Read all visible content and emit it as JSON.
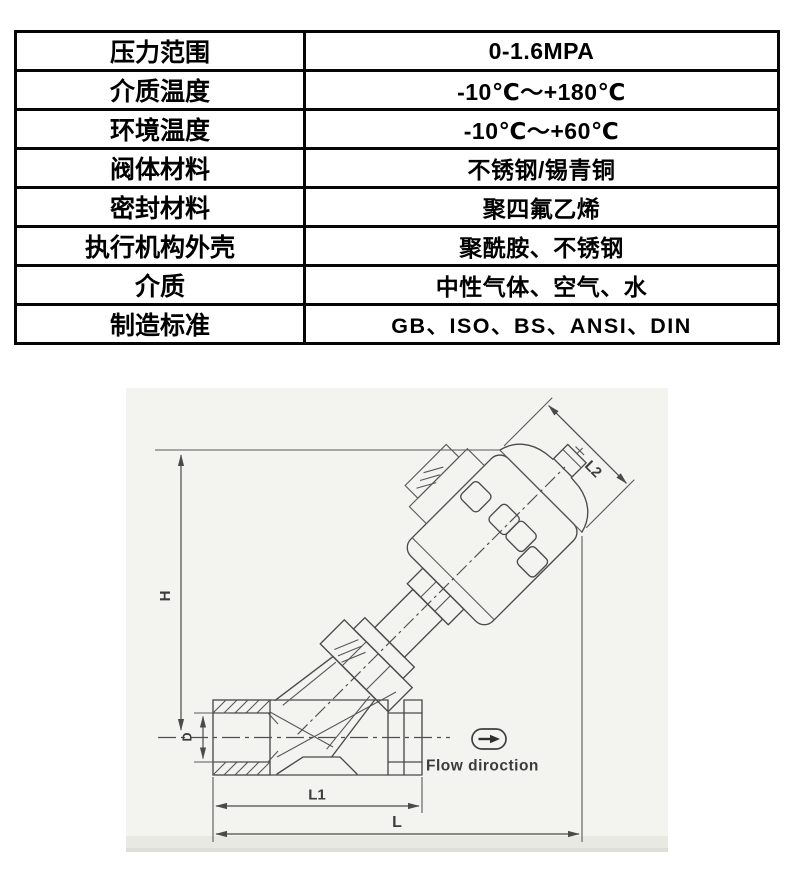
{
  "table": {
    "rows": [
      {
        "label": "压力范围",
        "value": "0-1.6MPA"
      },
      {
        "label": "介质温度",
        "value": "-10℃～+180℃"
      },
      {
        "label": "环境温度",
        "value": "-10℃～+60℃"
      },
      {
        "label": "阀体材料",
        "value": "不锈钢/锡青铜"
      },
      {
        "label": "密封材料",
        "value": "聚四氟乙烯"
      },
      {
        "label": "执行机构外壳",
        "value": "聚酰胺、不锈钢"
      },
      {
        "label": "介质",
        "value": "中性气体、空气、水"
      },
      {
        "label": "制造标准",
        "value": "GB、ISO、BS、ANSI、DIN"
      }
    ]
  },
  "diagram": {
    "type": "technical-drawing",
    "subject": "angle-seat-valve with pneumatic actuator",
    "labels": {
      "height": "H",
      "actuator_diameter": "L2",
      "port_diameter": "D",
      "body_length": "L1",
      "overall_length": "L",
      "flow": "Flow diroction"
    },
    "colors": {
      "line": "#4a4a4a",
      "label": "#3c3c3c",
      "photo_background": "#f3f3f0",
      "table_border": "#060606",
      "table_text": "#000000"
    }
  }
}
